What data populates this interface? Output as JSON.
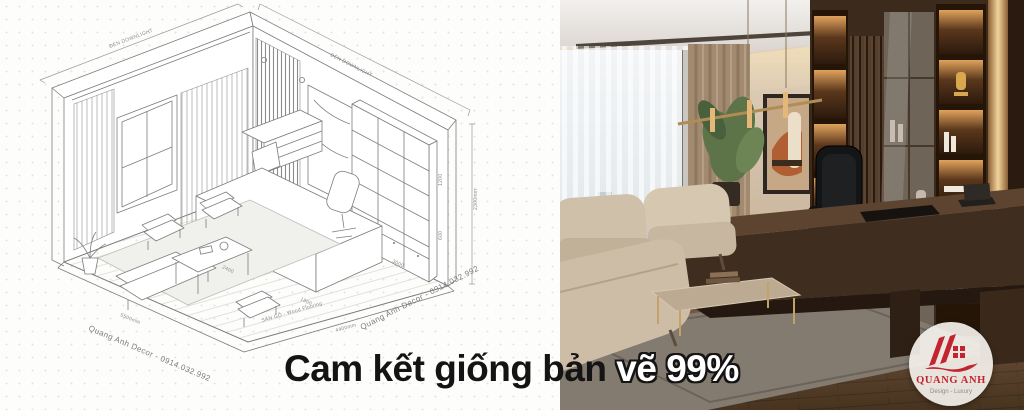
{
  "caption": {
    "prefix": "Cam kết giống bản ",
    "suffix": "vẽ 99%"
  },
  "logo": {
    "brand": "QUANG ANH",
    "tagline": "Design - Luxury",
    "accent": "#C32430",
    "tagline_color": "#8d8d8d"
  },
  "drawing": {
    "top_left_label": "ĐÈN DOWNLIGHT",
    "top_right_label": "ĐÈN DOWNLIGHT",
    "right_height_dim": "2300mm",
    "bottom_left_dim": "5500mm",
    "bottom_left_brand": "Quang Anh Decor - 0914.032.992",
    "bottom_right_dim": "4400mm",
    "bottom_right_brand": "Quang Anh Decor - 0914.032.992",
    "floor_label": "SÀN GỖ - Wood Flooring",
    "desk_watermark": "Quang Anh Decor - 0914.032.992",
    "dim_desk_length": "2400",
    "dim_walkway": "1800",
    "dim_chair_zone": "1200",
    "dim_cabinet_depth": "600",
    "dim_sofa_zone": "3000"
  }
}
